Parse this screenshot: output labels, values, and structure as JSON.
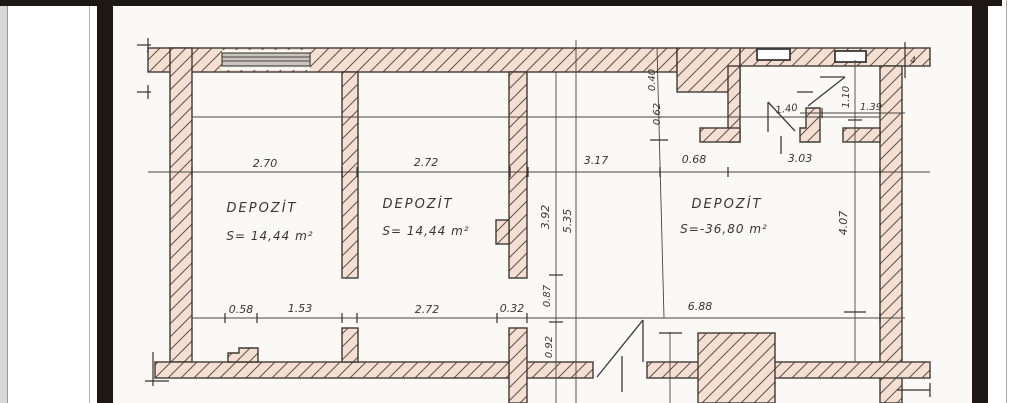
{
  "viewer": {
    "chrome_bar_color": "#1e1814",
    "paper_color": "#fbf9f6",
    "wall_fill_color": "#f5dfd3",
    "hatch_line_color": "#5a534b",
    "ink_color": "#3a352f"
  },
  "plan": {
    "rooms": [
      {
        "name": "DEPOZİT",
        "area": "S= 14,44 m²"
      },
      {
        "name": "DEPOZİT",
        "area": "S= 14,44 m²"
      },
      {
        "name": "DEPOZİT",
        "area": "S=-36,80 m²"
      }
    ],
    "dims_top": [
      "2.70",
      "2.72",
      "3.17",
      "0.68",
      "3.03"
    ],
    "dims_bottom": [
      "0.58",
      "1.53",
      "2.72",
      "0.32",
      "6.88"
    ],
    "dims_vertical": [
      "3.92",
      "5.35",
      "0.87",
      "0.92",
      "0.40",
      "0.62",
      "1.10",
      "4.07"
    ],
    "dims_other": [
      "1.40",
      "1.39",
      "4"
    ]
  }
}
